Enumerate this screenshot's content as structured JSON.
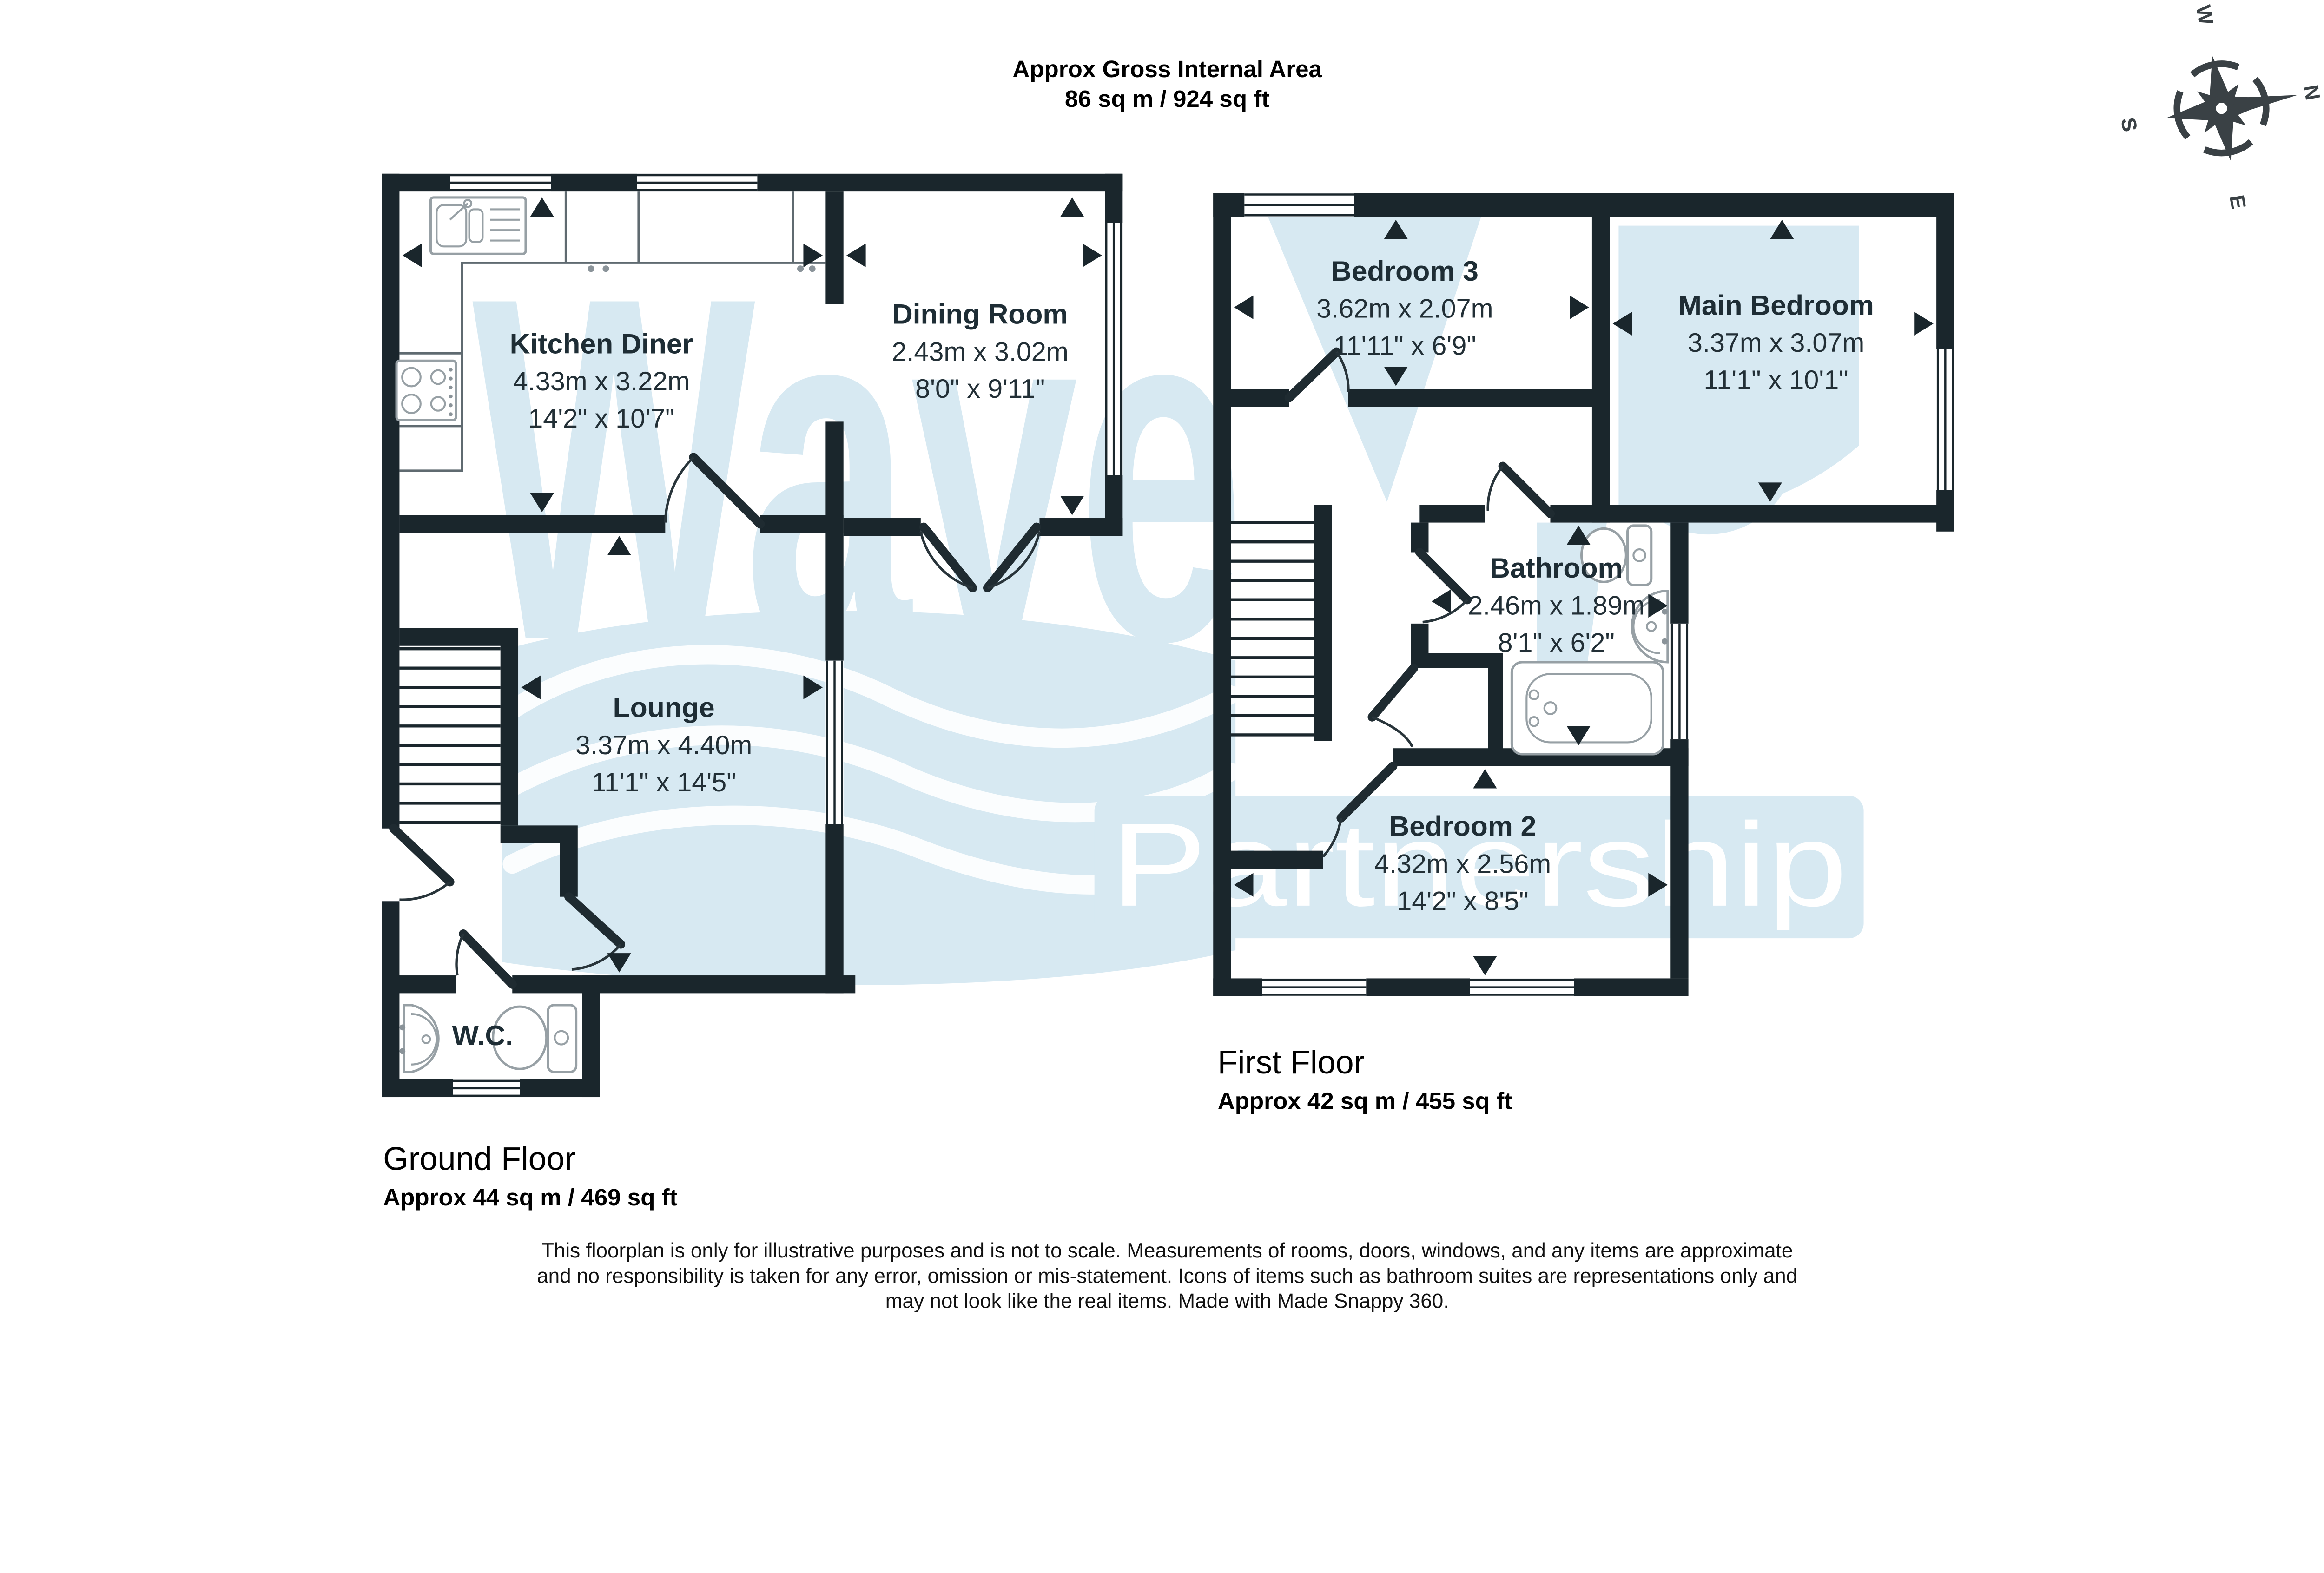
{
  "title": {
    "line1": "Approx Gross Internal Area",
    "line2": "86 sq m / 924 sq ft"
  },
  "colors": {
    "wall": "#1a262c",
    "watermark_blue": "#d7e9f2",
    "label_text": "#1e2d35",
    "fixture_outline": "#97a0a5"
  },
  "watermark": {
    "word": "Wave",
    "word2": "Partnership"
  },
  "compass": {
    "n": "N",
    "e": "E",
    "s": "S",
    "w": "W"
  },
  "ground_floor": {
    "heading": "Ground Floor",
    "area": "Approx 44 sq m / 469 sq ft",
    "rooms": [
      {
        "name": "Kitchen Diner",
        "metric": "4.33m x 3.22m",
        "imperial": "14'2\" x 10'7\""
      },
      {
        "name": "Dining Room",
        "metric": "2.43m x 3.02m",
        "imperial": "8'0\" x 9'11\""
      },
      {
        "name": "Lounge",
        "metric": "3.37m x 4.40m",
        "imperial": "11'1\" x 14'5\""
      },
      {
        "name": "W.C."
      }
    ]
  },
  "first_floor": {
    "heading": "First Floor",
    "area": "Approx 42 sq m / 455 sq ft",
    "rooms": [
      {
        "name": "Bedroom 3",
        "metric": "3.62m x 2.07m",
        "imperial": "11'11\" x 6'9\""
      },
      {
        "name": "Main Bedroom",
        "metric": "3.37m x 3.07m",
        "imperial": "11'1\" x 10'1\""
      },
      {
        "name": "Bathroom",
        "metric": "2.46m x 1.89m",
        "imperial": "8'1\" x 6'2\""
      },
      {
        "name": "Bedroom 2",
        "metric": "4.32m x 2.56m",
        "imperial": "14'2\" x 8'5\""
      }
    ]
  },
  "disclaimer": {
    "line1": "This floorplan is only for illustrative purposes and is not to scale. Measurements of rooms, doors, windows, and any items are approximate",
    "line2": "and no responsibility is taken for any error, omission or mis-statement. Icons of items such as bathroom suites are representations only and",
    "line3": "may not look like the real items. Made with Made Snappy 360."
  }
}
